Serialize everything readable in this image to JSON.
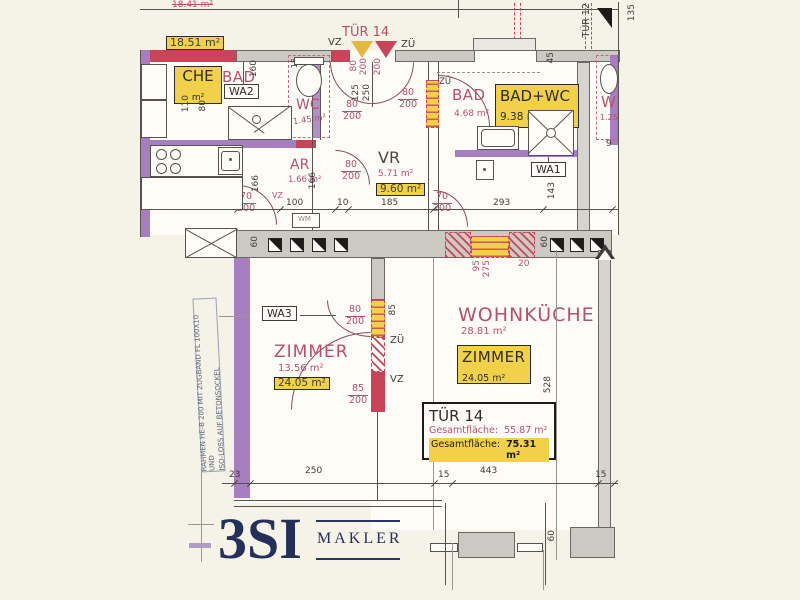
{
  "colors": {
    "background": "#f5f2e8",
    "accent_pink": "#b8506b",
    "wall_red": "#c94458",
    "wall_purple": "#a77fc0",
    "wall_gray": "#ccc9c3",
    "highlight_yellow": "#f1d04a",
    "line_dark": "#55534e",
    "logo_navy": "#24305a"
  },
  "units": {
    "top": {
      "area_old": "18.41 m²",
      "area_new": "18.51 m²"
    },
    "kueche": {
      "name": "CHE",
      "area": "m²"
    },
    "bad_top": {
      "name": "BAD",
      "area": "3.73 m²"
    },
    "wc_left": {
      "name": "WC",
      "area": "1.45 m²"
    },
    "ar": {
      "name": "AR",
      "area": "1.66 m²"
    },
    "vr": {
      "name": "VR",
      "area": "5.71 m²",
      "area_total": "9.60 m²"
    },
    "bad_right": {
      "name": "BAD",
      "area": "4.68 m²"
    },
    "bad_wc": {
      "name": "BAD+WC",
      "area": "9.38 m²"
    },
    "wc_right": {
      "name": "W",
      "area": "1.25"
    },
    "zimmer_left": {
      "name": "ZIMMER",
      "area": "13.56 m²",
      "area_total": "24.05 m²"
    },
    "wohnkueche": {
      "name": "WOHNKÜCHE",
      "area": "28.81 m²"
    },
    "zimmer_right": {
      "name": "ZIMMER",
      "area": "24.05 m²"
    }
  },
  "doors": {
    "tur14": "TÜR 14",
    "tur12": "TÜR 12",
    "vz": "VZ",
    "zu": "ZÜ"
  },
  "markers": {
    "wa1": "WA1",
    "wa2": "WA2",
    "wa3": "WA3",
    "wm": "WM"
  },
  "dims": {
    "n9": "9",
    "n10": "10",
    "n15": "15",
    "n20": "20",
    "n23": "23",
    "n45": "45",
    "n60": "60",
    "n70": "70",
    "n80": "80",
    "n85": "85",
    "n95": "95",
    "n100": "100",
    "n110": "110",
    "n125": "125",
    "n135": "135",
    "n143": "143",
    "n160": "160",
    "n166": "166",
    "n185": "185",
    "n200": "200",
    "n233": "233",
    "n250": "250",
    "n275": "275",
    "n293": "293",
    "n443": "443",
    "n528": "528"
  },
  "info_box": {
    "title": "TÜR 14",
    "row1_label": "Gesamtfläche:",
    "row1_value": "55.87 m²",
    "row2_label": "Gesamtfläche:",
    "row2_value": "75.31 m²"
  },
  "side_note": {
    "line1": "RAHMEN HE-B 200 MIT ZUGBAND FL 100X10 UND",
    "line2": "ISO-LOSS AUF BETONSOCKEL"
  },
  "logo": {
    "brand": "3SI",
    "suffix": "MAKLER"
  }
}
